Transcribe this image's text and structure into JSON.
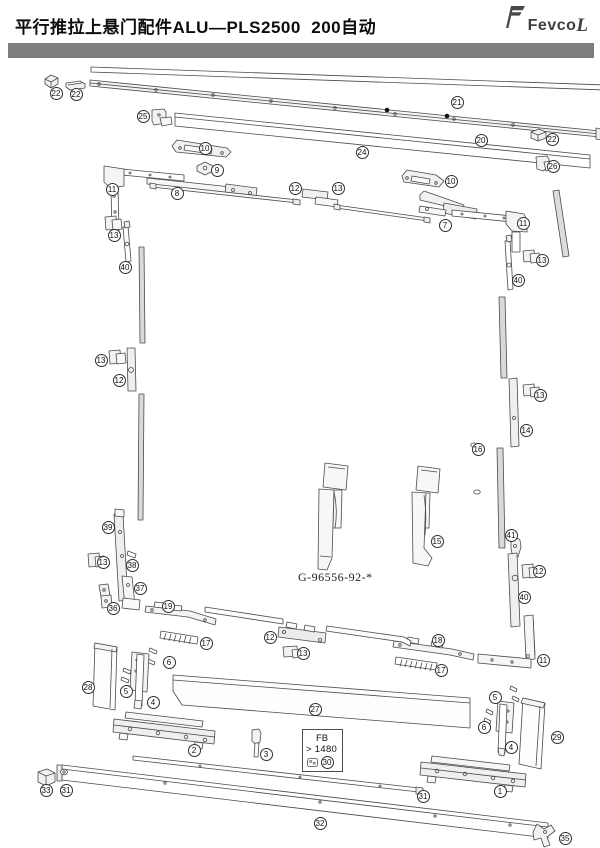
{
  "header": {
    "title": "平行推拉上悬门配件ALU—PLS2500  200自动",
    "logo_text": "Fevco",
    "logo_suffix": "L"
  },
  "colors": {
    "header_bar": "#7d7d7d",
    "line_art": "#4a4a4a",
    "rail_fill": "#d9d9d9"
  },
  "diagram": {
    "part_number_label": "G-96556-92-*",
    "fb_box": {
      "line1": "FB",
      "line2": "> 1480"
    },
    "callouts": [
      {
        "n": "22",
        "x": 56,
        "y": 93
      },
      {
        "n": "22",
        "x": 76,
        "y": 94
      },
      {
        "n": "25",
        "x": 143,
        "y": 116
      },
      {
        "n": "21",
        "x": 457,
        "y": 102
      },
      {
        "n": "20",
        "x": 481,
        "y": 140
      },
      {
        "n": "22",
        "x": 552,
        "y": 139
      },
      {
        "n": "24",
        "x": 362,
        "y": 152
      },
      {
        "n": "26",
        "x": 553,
        "y": 166
      },
      {
        "n": "10",
        "x": 205,
        "y": 148
      },
      {
        "n": "9",
        "x": 217,
        "y": 170
      },
      {
        "n": "11",
        "x": 112,
        "y": 189
      },
      {
        "n": "8",
        "x": 177,
        "y": 193
      },
      {
        "n": "12",
        "x": 295,
        "y": 188
      },
      {
        "n": "13",
        "x": 338,
        "y": 188
      },
      {
        "n": "10",
        "x": 451,
        "y": 181
      },
      {
        "n": "7",
        "x": 445,
        "y": 225
      },
      {
        "n": "11",
        "x": 523,
        "y": 223
      },
      {
        "n": "13",
        "x": 114,
        "y": 235
      },
      {
        "n": "40",
        "x": 125,
        "y": 267
      },
      {
        "n": "13",
        "x": 542,
        "y": 260
      },
      {
        "n": "40",
        "x": 518,
        "y": 280
      },
      {
        "n": "13",
        "x": 101,
        "y": 360
      },
      {
        "n": "12",
        "x": 119,
        "y": 380
      },
      {
        "n": "13",
        "x": 540,
        "y": 395
      },
      {
        "n": "14",
        "x": 526,
        "y": 430
      },
      {
        "n": "16",
        "x": 478,
        "y": 449
      },
      {
        "n": "15",
        "x": 437,
        "y": 541
      },
      {
        "n": "39",
        "x": 108,
        "y": 527
      },
      {
        "n": "13",
        "x": 103,
        "y": 562
      },
      {
        "n": "38",
        "x": 132,
        "y": 565
      },
      {
        "n": "37",
        "x": 140,
        "y": 588
      },
      {
        "n": "36",
        "x": 113,
        "y": 608
      },
      {
        "n": "19",
        "x": 168,
        "y": 606
      },
      {
        "n": "17",
        "x": 206,
        "y": 643
      },
      {
        "n": "6",
        "x": 169,
        "y": 662
      },
      {
        "n": "12",
        "x": 270,
        "y": 637
      },
      {
        "n": "13",
        "x": 303,
        "y": 653
      },
      {
        "n": "18",
        "x": 438,
        "y": 640
      },
      {
        "n": "17",
        "x": 441,
        "y": 670
      },
      {
        "n": "41",
        "x": 511,
        "y": 535
      },
      {
        "n": "12",
        "x": 539,
        "y": 571
      },
      {
        "n": "40",
        "x": 524,
        "y": 597
      },
      {
        "n": "11",
        "x": 543,
        "y": 660
      },
      {
        "n": "28",
        "x": 88,
        "y": 687
      },
      {
        "n": "5",
        "x": 126,
        "y": 691
      },
      {
        "n": "4",
        "x": 153,
        "y": 702
      },
      {
        "n": "27",
        "x": 315,
        "y": 709
      },
      {
        "n": "5",
        "x": 495,
        "y": 697
      },
      {
        "n": "6",
        "x": 484,
        "y": 727
      },
      {
        "n": "4",
        "x": 511,
        "y": 747
      },
      {
        "n": "29",
        "x": 557,
        "y": 737
      },
      {
        "n": "2",
        "x": 194,
        "y": 750
      },
      {
        "n": "3",
        "x": 266,
        "y": 754
      },
      {
        "n": "33",
        "x": 46,
        "y": 790
      },
      {
        "n": "31",
        "x": 66,
        "y": 790
      },
      {
        "n": "30",
        "x": 327,
        "y": 762
      },
      {
        "n": "31",
        "x": 423,
        "y": 796
      },
      {
        "n": "32",
        "x": 320,
        "y": 823
      },
      {
        "n": "1",
        "x": 500,
        "y": 791
      },
      {
        "n": "35",
        "x": 565,
        "y": 838
      }
    ]
  }
}
